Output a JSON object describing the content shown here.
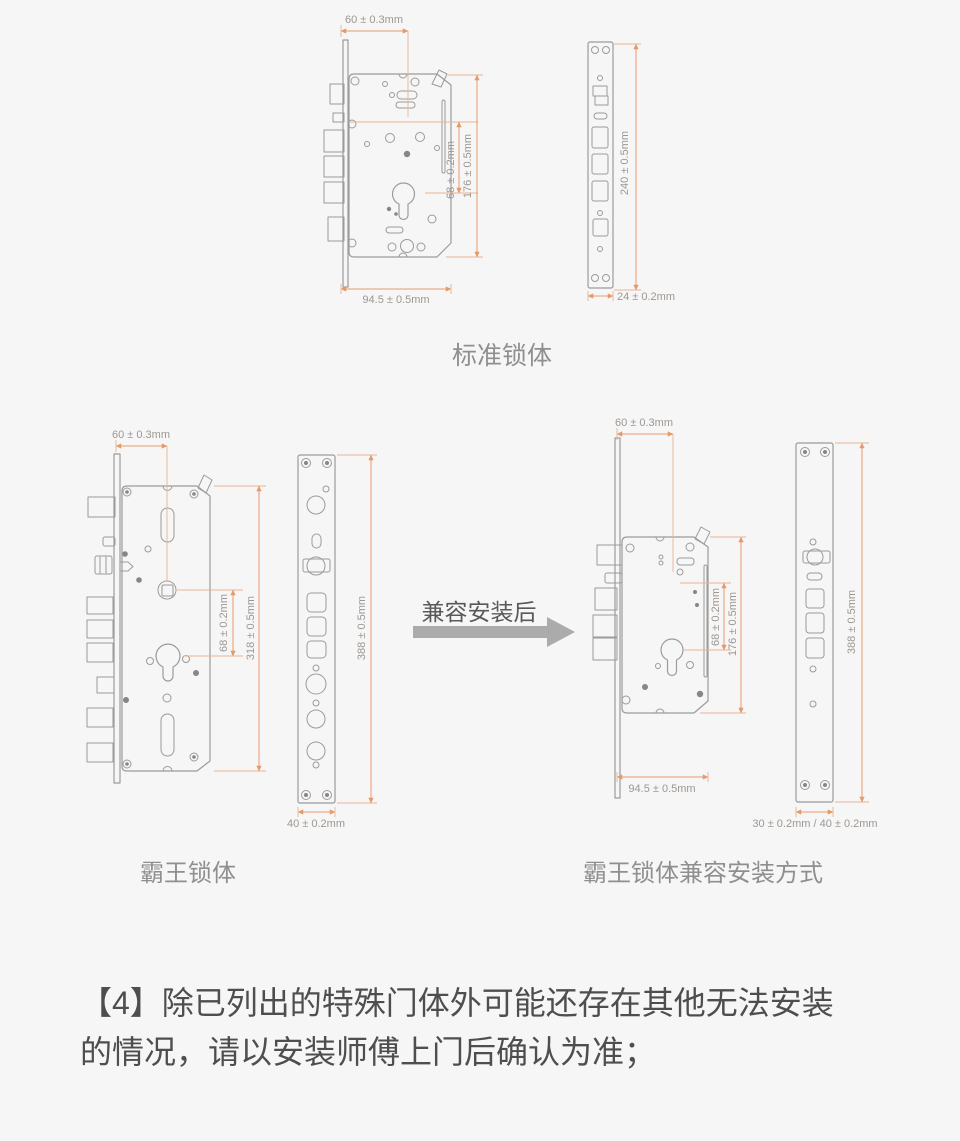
{
  "figures": {
    "standard": {
      "label": "标准锁体",
      "dims": {
        "top_width": "60 ± 0.3mm",
        "hole_spacing": "68 ± 0.2mm",
        "body_height": "176 ± 0.5mm",
        "bottom_width": "94.5 ± 0.5mm",
        "faceplate_height": "240 ± 0.5mm",
        "faceplate_width": "24 ± 0.2mm"
      }
    },
    "overlord": {
      "label": "霸王锁体",
      "dims": {
        "top_width": "60 ± 0.3mm",
        "hole_spacing": "68 ± 0.2mm",
        "body_height": "318 ± 0.5mm",
        "faceplate_height": "388 ± 0.5mm",
        "faceplate_width": "40 ± 0.2mm"
      }
    },
    "compatible": {
      "label": "霸王锁体兼容安装方式",
      "dims": {
        "top_width": "60 ± 0.3mm",
        "hole_spacing": "68 ± 0.2mm",
        "body_height": "176 ± 0.5mm",
        "bottom_width": "94.5 ± 0.5mm",
        "faceplate_height": "388 ± 0.5mm",
        "faceplate_width": "30 ± 0.2mm / 40 ± 0.2mm"
      }
    }
  },
  "arrow": {
    "label": "兼容安装后"
  },
  "note": {
    "line1": "【4】除已列出的特殊门体外可能还存在其他无法安装",
    "line2": "的情况，请以安装师傅上门后确认为准；"
  },
  "colors": {
    "background": "#f6f6f6",
    "line_art": "#9b9b9b",
    "dimension_line": "#e59a6b",
    "dimension_text": "#9d9792",
    "label_text": "#8f8f8f",
    "note_text": "#4e4e4e",
    "arrow_fill": "#ababab",
    "arrow_label": "#595959"
  }
}
